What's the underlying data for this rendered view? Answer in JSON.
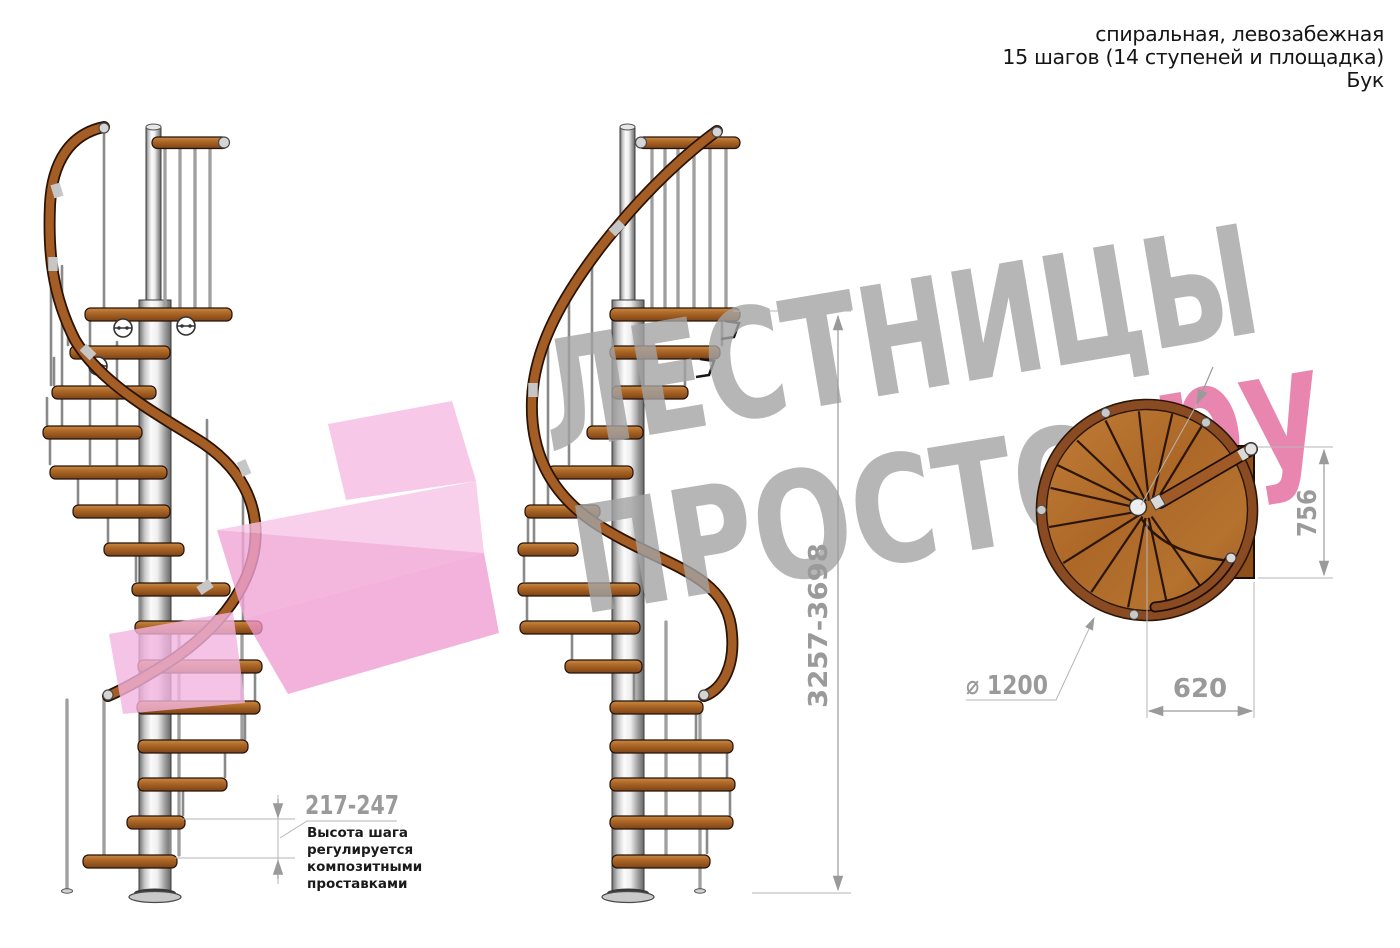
{
  "title_block": {
    "line1": "спиральная, левозабежная",
    "line2": "15 шагов (14 ступеней и площадка)",
    "line3": "Бук"
  },
  "watermark": {
    "line1": "ЛЕСТНИЦЫ",
    "line2": "ПРОСТО",
    "suffix": ".ру"
  },
  "dimensions": {
    "total_height": "3257-3698",
    "step_height": "217-247",
    "diameter": "⌀ 1200",
    "landing_width": "620",
    "landing_depth": "756"
  },
  "annotation": {
    "line1": "Высота шага",
    "line2": "регулируется",
    "line3": "композитными",
    "line4": "проставками"
  },
  "colors": {
    "dimension_gray": "#9a9a9a",
    "watermark_gray": "#a4a4a4",
    "watermark_pink": "#dc3d80",
    "arrow_pink": "#f0a8d4",
    "wood_light": "#c88a46",
    "wood_dark": "#7c4316",
    "rail_brown": "#a45d24",
    "pole_metal": "#d9d9d9"
  }
}
